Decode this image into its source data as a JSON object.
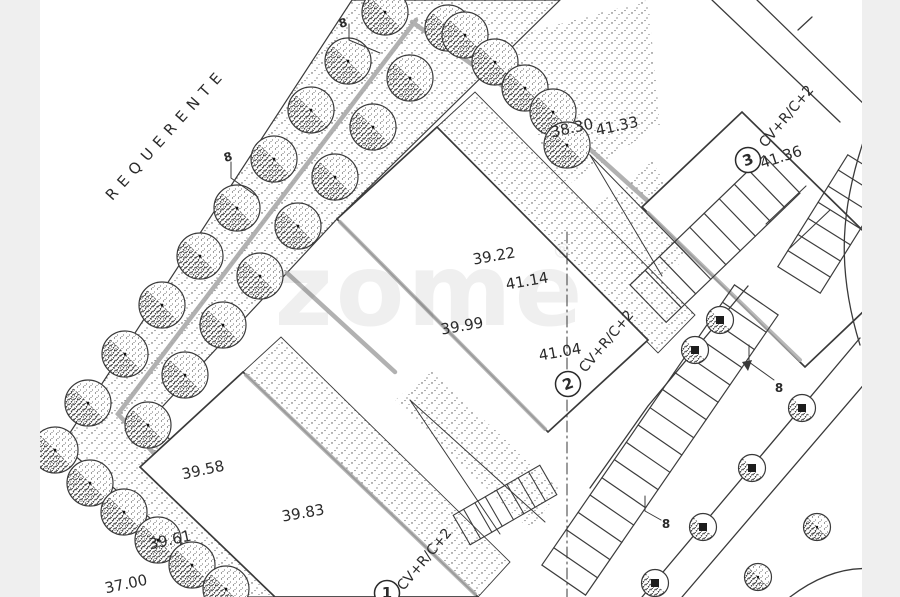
{
  "page": {
    "background_color": "#efefef",
    "paper_color": "#ffffff",
    "line_color": "#3a3a3a",
    "path_gray": "#a9a9a9"
  },
  "annotations": {
    "requerente": "REQUERENTE",
    "point_marker": "8"
  },
  "plots": {
    "p1": {
      "number": "1",
      "building_type": "CV+R/C+2",
      "elevations": {
        "a": "39.58",
        "b": "39.83",
        "c": "39.61",
        "d": "37.00"
      }
    },
    "p2": {
      "number": "2",
      "building_type": "CV+R/C+2",
      "elevations": {
        "a": "39.22",
        "b": "41.14",
        "c": "39.99",
        "d": "41.04"
      }
    },
    "p3": {
      "number": "3",
      "building_type": "CV+R/C+2",
      "elevations": {
        "a": "38.30",
        "b": "41.33",
        "c": "41.36"
      }
    }
  },
  "watermark": {
    "text": "zome",
    "symbol": "®"
  }
}
